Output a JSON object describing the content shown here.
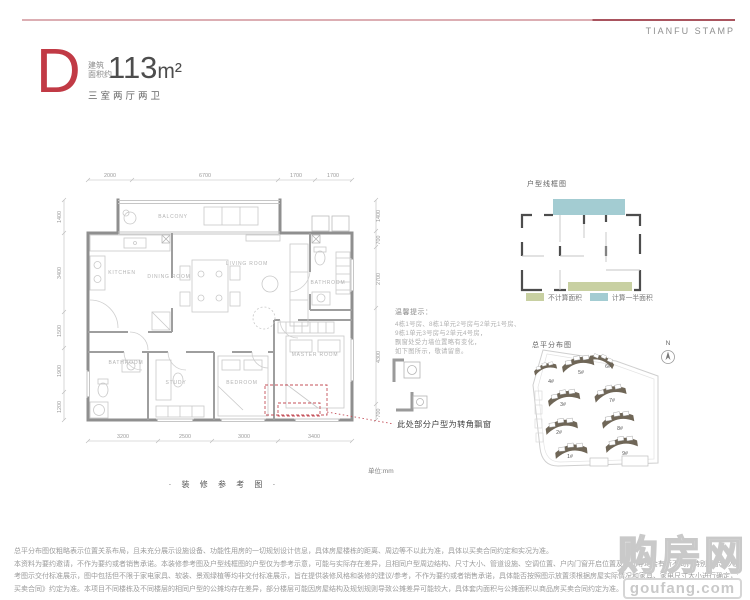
{
  "brand": {
    "name": "TIANFU STAMP"
  },
  "unit": {
    "letter": "D",
    "area_label_top": "建筑",
    "area_label_bottom": "面积约",
    "area_value": "113",
    "area_unit": "m²",
    "layout": "三室两厅两卫"
  },
  "plan": {
    "caption": "· 装 修 参 考 图 ·",
    "unit_note": "单位:mm",
    "corner_note": "此处部分户型为转角飘窗",
    "rooms": {
      "balcony": "BALCONY",
      "kitchen": "KITCHEN",
      "dining": "DINING ROOM",
      "living": "LIVING ROOM",
      "bath1": "BATHROOM",
      "bath2": "BATHROOM",
      "master": "MASTER ROOM",
      "study": "STUDY",
      "bedroom": "BEDROOM"
    },
    "dims": {
      "top": [
        "2000",
        "6700",
        "1700",
        "1700"
      ],
      "left": [
        "1400",
        "3400",
        "1500",
        "1900",
        "1200"
      ],
      "right": [
        "1400",
        "700",
        "2700",
        "4300",
        "700"
      ],
      "bottom": [
        "3200",
        "2500",
        "3000",
        "3400"
      ]
    },
    "tips": {
      "title": "温馨提示：",
      "lines": [
        "4栋1号房、8栋1单元2号房与2单元1号房、",
        "9栋1单元3号房与2单元4号房，",
        "飘窗处受力墙位置略有变化，",
        "如下图所示，敬请留意。"
      ]
    }
  },
  "wireframe": {
    "title": "户型线框图",
    "legend": [
      {
        "label": "不计算面积",
        "color": "#c8d0a2"
      },
      {
        "label": "计算一半面积",
        "color": "#a3ccd2"
      }
    ]
  },
  "siteplan": {
    "title": "总平分布图",
    "north": "N",
    "buildings": [
      "4#",
      "5#",
      "6#",
      "3#",
      "7#",
      "2#",
      "8#",
      "1#",
      "9#"
    ]
  },
  "disclaimer": {
    "lines": [
      "总平分布图仅粗略表示位置关系布局，且未充分展示设施设备、功能性用房的一切规划设计信息，具体房屋楼栋的距离、周边等不以此为准，具体以买卖合同约定和实况为准。",
      "本资料为要约邀请，不作为要约或者销售承诺。本装修参考图及户型线框图的户型仅为参考示意，可能与实际存在差异，且相同户型周边结构、尺寸大小、管道设施、空调位置、户内门窗开启位置及方向等均会有所不同，特别提示：入户玄关处墙面有所装饰，需以实际交付为准，本参",
      "考图示交付标准展示，图中包括但不限于家电家具、软装、景观绿植等均非交付标准展示，旨在提供装修风格和装修的建议/参考，不作为要约或者销售承诺，具体能否按照图示放置须根据房屋实际情况和家具、家电尺寸大小进行确定，请业主购买之前到现场核实相应尺寸；买卖双方的权利义务以《商品房",
      "买卖合同》约定为准。本项目不同楼栋及不同楼层的相同户型的公摊均存在差异，部分楼层可能因房屋结构及规划规则导致公摊差异可能较大，具体套内面积与公摊面积以商品房买卖合同约定为准。"
    ]
  },
  "watermark": {
    "name": "购房网",
    "domain": "goufang.com"
  },
  "colors": {
    "accent": "#c13a45",
    "teal": "#a3ccd2",
    "green": "#c8d0a2",
    "building": "#6f6657"
  }
}
